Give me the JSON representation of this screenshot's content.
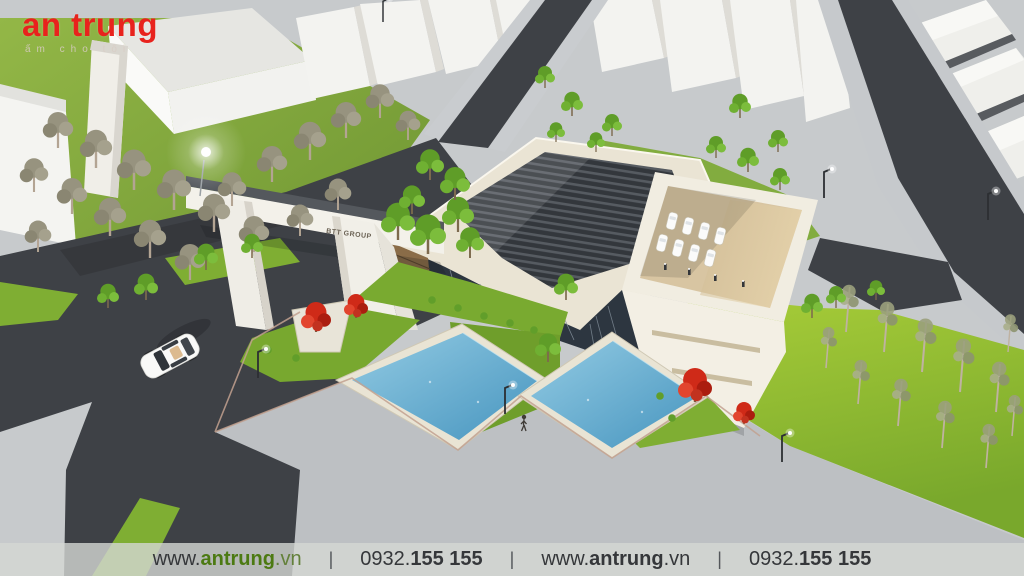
{
  "logo": {
    "brand": "an trung",
    "tagline": "ấm cho tôi"
  },
  "gate": {
    "sign": "BTT GROUP"
  },
  "footer": {
    "separator": "|",
    "items": [
      {
        "prefix": "www.",
        "bold": "antrung",
        "suffix": ".vn"
      },
      {
        "prefix": "0932.",
        "bold": "155 155",
        "suffix": ""
      },
      {
        "prefix": "www.",
        "bold": "antrung",
        "suffix": ".vn"
      },
      {
        "prefix": "0932.",
        "bold": "155 155",
        "suffix": ""
      }
    ]
  },
  "palette": {
    "logo_red": "#e8231d",
    "footer_text": "#35373a",
    "footer_green": "#4c7a12",
    "road": "#3e4146",
    "sidewalk": "#c6c9cc",
    "walkway": "#bdc0c3",
    "grass_bright": "#8fbe2f",
    "grass_mid": "#79a92e",
    "pool_water": "#58a6cd",
    "roof_cream": "#eae4d4",
    "roof_dark": "#33373c",
    "courtyard_tan": "#d8c5a2",
    "flower_red": "#cf2a18",
    "building_white": "#f3efe4"
  }
}
